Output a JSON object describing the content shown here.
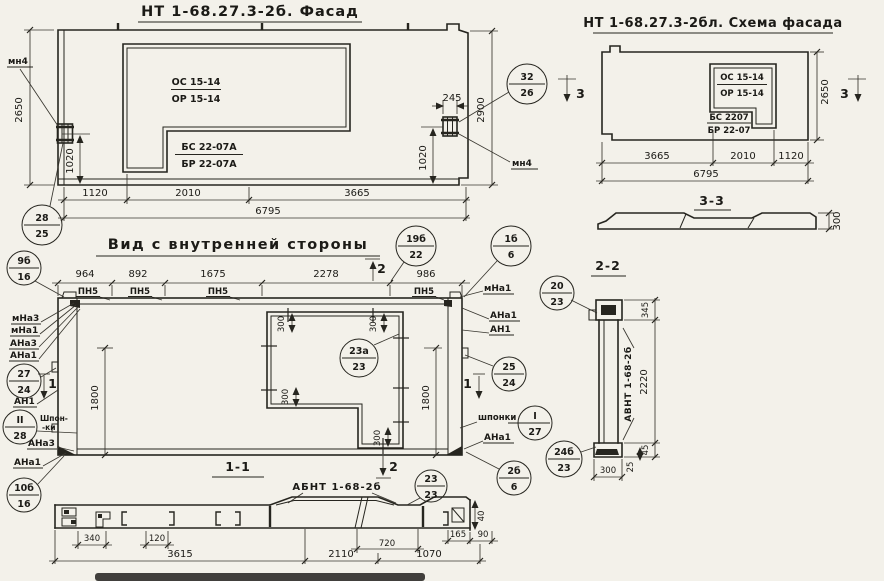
{
  "colors": {
    "ink": "#26251f",
    "paper": "#f3f1ea"
  },
  "facade": {
    "title": "НТ 1-68.27.3-2б. Фасад",
    "window": {
      "os": "ОС 15-14",
      "or": "ОР 15-14",
      "bs": "БС 22-07А",
      "br": "БР 22-07А"
    },
    "mark_left": "мн4",
    "mark_right": "мн4",
    "dims": {
      "h_left": "2650",
      "h_right": "2900",
      "anchor_left": "1020",
      "anchor_right": "1020",
      "anchor_width": "245",
      "b1": "1120",
      "b2": "2010",
      "b3": "3665",
      "total": "6795"
    },
    "callout_bl": {
      "top": "28",
      "bot": "25"
    },
    "callout_right": {
      "top": "32",
      "bot": "26"
    }
  },
  "schema": {
    "title": "НТ 1-68.27.3-2бл. Схема фасада",
    "window": {
      "os": "ОС 15-14",
      "or": "ОР 15-14",
      "bs": "БС 2207",
      "br": "БР 22-07"
    },
    "section_mark": "3",
    "dims": {
      "h": "2650",
      "b1": "3665",
      "b2": "2010",
      "b3": "1120",
      "total": "6795"
    }
  },
  "section33": {
    "title": "3-3",
    "thickness": "300"
  },
  "inner": {
    "title": "Вид с внутренней стороны",
    "pn5": "ПН5",
    "sec1": "1",
    "sec2": "2",
    "dims": {
      "t1": "964",
      "t2": "892",
      "t3": "1675",
      "t4": "2278",
      "t5": "986",
      "h_left": "1800",
      "h_right": "1800",
      "win300": "300"
    },
    "left": {
      "mna3": "мНа3",
      "mna1": "мНа1",
      "ana3": "АНа3",
      "ana1": "АНа1",
      "an1": "АН1",
      "shpon1": "Шпон-",
      "shpon2": "-ки",
      "ana3b": "АНа3",
      "ana1b": "АНа1"
    },
    "right": {
      "mna1": "мНа1",
      "ana1": "АНа1",
      "an1": "АН1",
      "shponki": "шпонки",
      "ana1b": "АНа1"
    },
    "c9b16": {
      "top": "9б",
      "bot": "16"
    },
    "c27_24": {
      "top": "27",
      "bot": "24"
    },
    "cII28": {
      "top": "II",
      "bot": "28"
    },
    "c10b16": {
      "top": "10б",
      "bot": "16"
    },
    "c19b22": {
      "top": "19б",
      "bot": "22"
    },
    "c1b6": {
      "top": "1б",
      "bot": "6"
    },
    "c25_24": {
      "top": "25",
      "bot": "24"
    },
    "cI27": {
      "top": "I",
      "bot": "27"
    },
    "c23a23": {
      "top": "23а",
      "bot": "23"
    },
    "c2b6": {
      "top": "2б",
      "bot": "6"
    }
  },
  "section22": {
    "title": "2-2",
    "label": "АВНТ 1-68-2б",
    "dims": {
      "top": "345",
      "mid": "2220",
      "d45": "45",
      "d25": "25",
      "width": "300"
    },
    "c20_23": {
      "top": "20",
      "bot": "23"
    },
    "c24b23": {
      "top": "24б",
      "bot": "23"
    }
  },
  "section11": {
    "title": "1-1",
    "label": "АБНТ 1-68-2б",
    "sec2": "2",
    "dims": {
      "d340": "340",
      "d120": "120",
      "d3615": "3615",
      "d2110": "2110",
      "d720": "720",
      "d1070": "1070",
      "d165": "165",
      "d90": "90",
      "d40": "40"
    },
    "c23_23": {
      "top": "23",
      "bot": "23"
    }
  }
}
